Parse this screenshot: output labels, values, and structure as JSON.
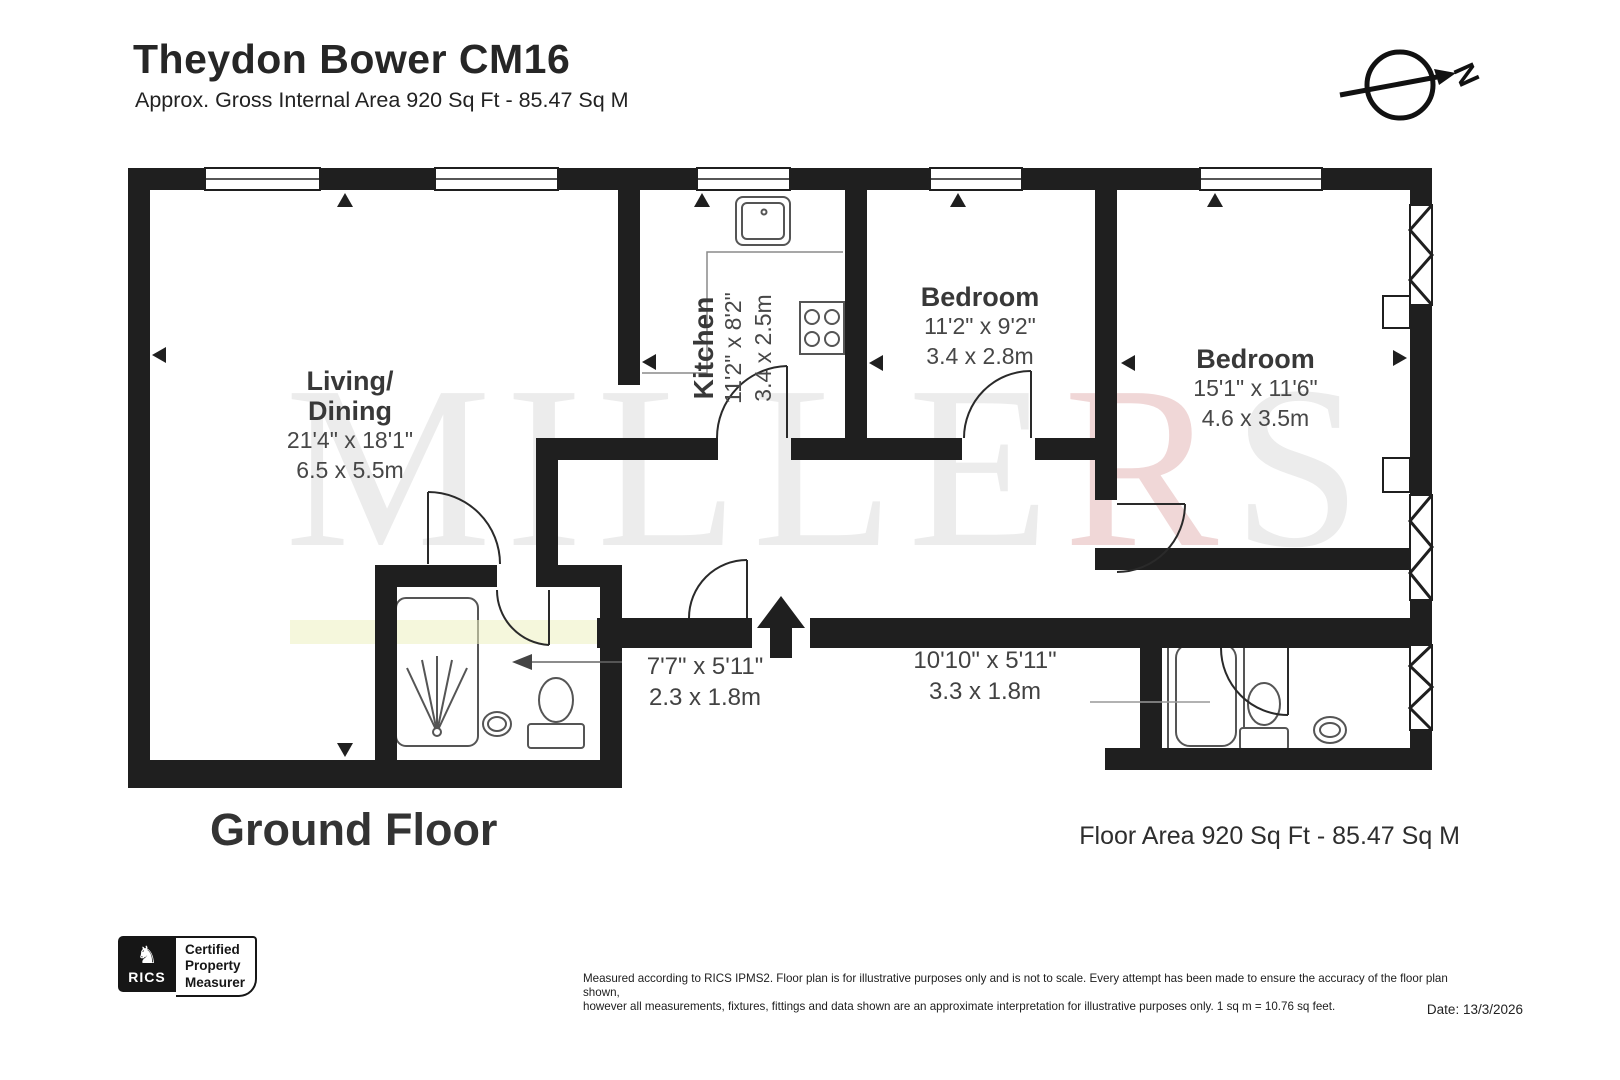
{
  "header": {
    "title": "Theydon Bower CM16",
    "subtitle": "Approx. Gross Internal Area 920 Sq Ft - 85.47 Sq M"
  },
  "compass": {
    "label": "N"
  },
  "watermark": {
    "part1": "MILLE",
    "part2": "R",
    "part3": "S"
  },
  "plan": {
    "rooms": {
      "living": {
        "name_line1": "Living/",
        "name_line2": "Dining",
        "imperial": "21'4\" x 18'1\"",
        "metric": "6.5 x 5.5m"
      },
      "kitchen": {
        "name": "Kitchen",
        "imperial": "11'2\" x 8'2\"",
        "metric": "3.4 x 2.5m"
      },
      "bedroom1": {
        "name": "Bedroom",
        "imperial": "11'2\" x 9'2\"",
        "metric": "3.4 x 2.8m"
      },
      "bedroom2": {
        "name": "Bedroom",
        "imperial": "15'1\" x 11'6\"",
        "metric": "4.6 x 3.5m"
      },
      "hallway": {
        "imperial": "7'7\" x 5'11\"",
        "metric": "2.3 x 1.8m"
      },
      "landing": {
        "imperial": "10'10\" x 5'11\"",
        "metric": "3.3 x 1.8m"
      }
    }
  },
  "footer": {
    "floor_label": "Ground Floor",
    "floor_area": "Floor Area 920 Sq Ft - 85.47 Sq M"
  },
  "badge": {
    "org": "RICS",
    "lines": [
      "Certified",
      "Property",
      "Measurer"
    ]
  },
  "disclaimer": {
    "line1": "Measured according to RICS IPMS2. Floor plan is for illustrative purposes only and is not to scale. Every attempt has been made to ensure the accuracy of the floor plan shown,",
    "line2": "however all measurements, fixtures, fittings and data shown are an approximate interpretation for illustrative purposes only. 1 sq m = 10.76 sq feet."
  },
  "date_label": "Date: 13/3/2026",
  "colors": {
    "wall": "#1f1f1f",
    "fixture_stroke": "#555555",
    "watermark_gray": "#ececec",
    "watermark_red": "#f0d7d7",
    "highlight_band": "#edf0c0"
  }
}
